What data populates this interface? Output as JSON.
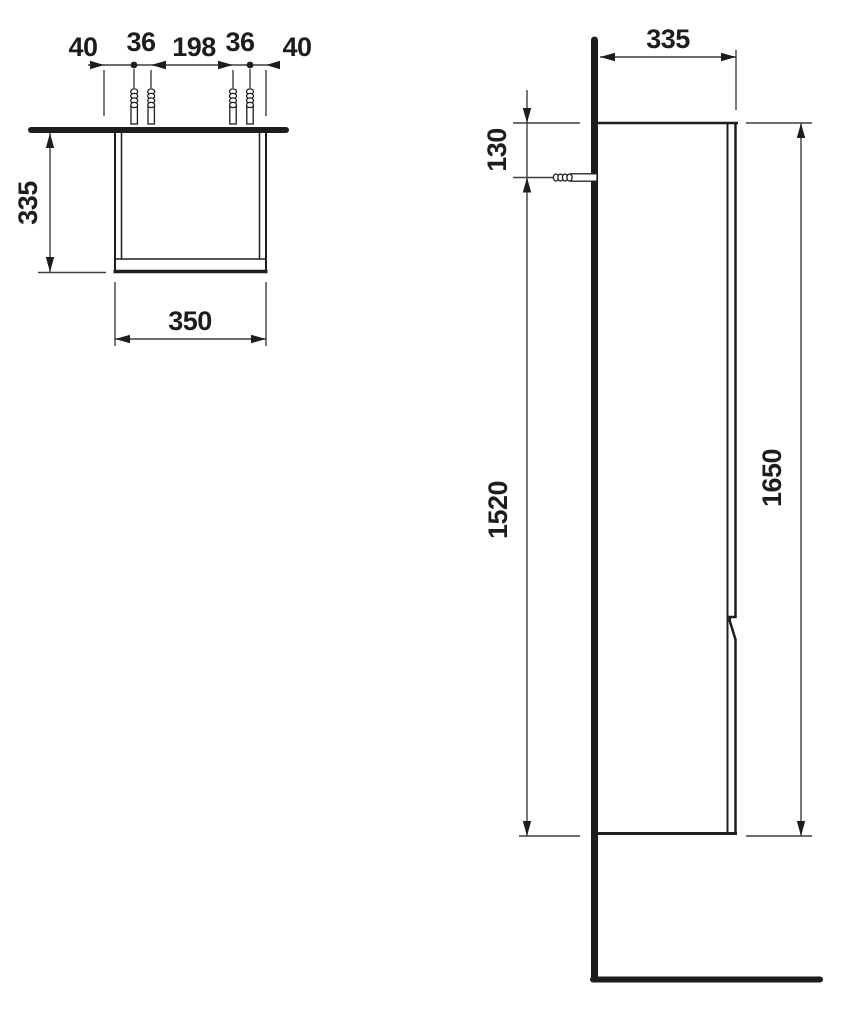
{
  "canvas": {
    "background": "#ffffff",
    "line_color": "#1d1d1b",
    "thin_line_color": "#3f3f3f",
    "drawing_kind": "furniture technical drawing, two orthographic views of a wall-hung tall cabinet"
  },
  "top_view": {
    "chain": [
      "40",
      "36",
      "198",
      "36",
      "40"
    ],
    "depth": "335",
    "width": "350"
  },
  "side_view": {
    "depth": "335",
    "fixing_from_top": "130",
    "fixing_to_bottom": "1520",
    "height": "1650"
  }
}
